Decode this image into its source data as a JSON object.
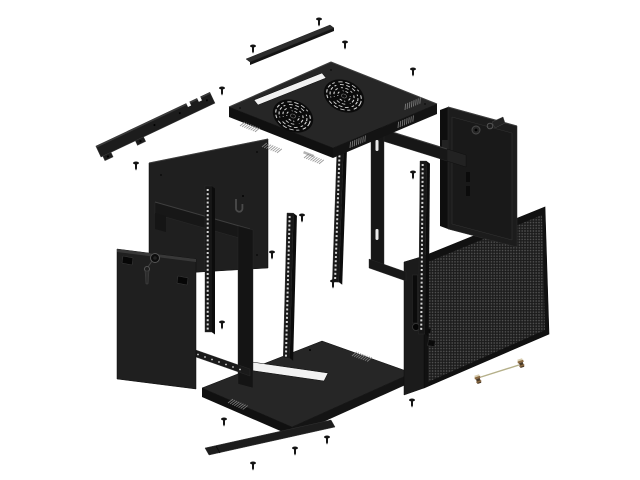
{
  "image_type": "exploded-view product diagram of a wall-mount server rack cabinet",
  "background": "#ffffff",
  "palette": {
    "background": "#ffffff",
    "panel": "#1f1f1f",
    "panel_top": "#262626",
    "panel_shadow": "#101010",
    "frame": "#171717",
    "edge_highlight": "#3e3e3e",
    "hole": "#f2f2f2",
    "rail_hole": "#d6d6d6",
    "mesh_bg": "#1c1c1c",
    "mesh_dot": "#555555",
    "screw": "#141414",
    "brass_dark": "#4a3a28",
    "brass_mid": "#8a6a42",
    "brass_light": "#d8cdb0",
    "wire": "#b5b08a"
  },
  "parts": [
    {
      "id": "blanking-strip",
      "label": "top blanking strip"
    },
    {
      "id": "top-panel",
      "label": "top panel with dual fan grilles and cable slot"
    },
    {
      "id": "wall-bracket",
      "label": "notched wall-mount bracket"
    },
    {
      "id": "back-panel",
      "label": "rear panel"
    },
    {
      "id": "cable-hook",
      "label": "cable hook on rear panel"
    },
    {
      "id": "side-panel-left",
      "label": "left side panel with cam lock and key"
    },
    {
      "id": "wall-frame",
      "label": "wall frame beams and post"
    },
    {
      "id": "frame-right",
      "label": "right frame beams and post"
    },
    {
      "id": "rack-rail",
      "label": "19-inch mounting rail with square holes"
    },
    {
      "id": "bottom-panel",
      "label": "bottom panel with cable cutout"
    },
    {
      "id": "kick-strip",
      "label": "bottom cover strip"
    },
    {
      "id": "mesh-door",
      "label": "perforated mesh door with swing lock"
    },
    {
      "id": "front-door",
      "label": "front door panel with lock cylinder and key"
    },
    {
      "id": "ground-wire",
      "label": "grounding wire with brass screws"
    },
    {
      "id": "screw",
      "label": "mounting screw"
    }
  ],
  "fans": {
    "count": 2,
    "radius": 20,
    "positions": [
      [
        293,
        116
      ],
      [
        344,
        96
      ]
    ]
  },
  "rails": [
    {
      "x": 205,
      "y": 186,
      "h": 146,
      "tilt": 0
    },
    {
      "x": 287,
      "y": 213,
      "h": 145,
      "tilt": 1.5
    },
    {
      "x": 337,
      "y": 148,
      "h": 134,
      "tilt": 2
    },
    {
      "x": 420,
      "y": 161,
      "h": 173,
      "tilt": 0.5
    }
  ],
  "screws": {
    "black": [
      [
        253,
        46
      ],
      [
        319,
        19
      ],
      [
        345,
        42
      ],
      [
        413,
        69
      ],
      [
        222,
        88
      ],
      [
        136,
        163
      ],
      [
        413,
        172
      ],
      [
        302,
        215
      ],
      [
        272,
        252
      ],
      [
        333,
        281
      ],
      [
        222,
        322
      ],
      [
        224,
        419
      ],
      [
        253,
        463
      ],
      [
        295,
        448
      ],
      [
        327,
        437
      ],
      [
        412,
        400
      ]
    ],
    "brass": [
      [
        478,
        379
      ],
      [
        521,
        363
      ]
    ]
  },
  "ground_wire": {
    "x1": 481,
    "y1": 377,
    "x2": 519,
    "y2": 365
  }
}
